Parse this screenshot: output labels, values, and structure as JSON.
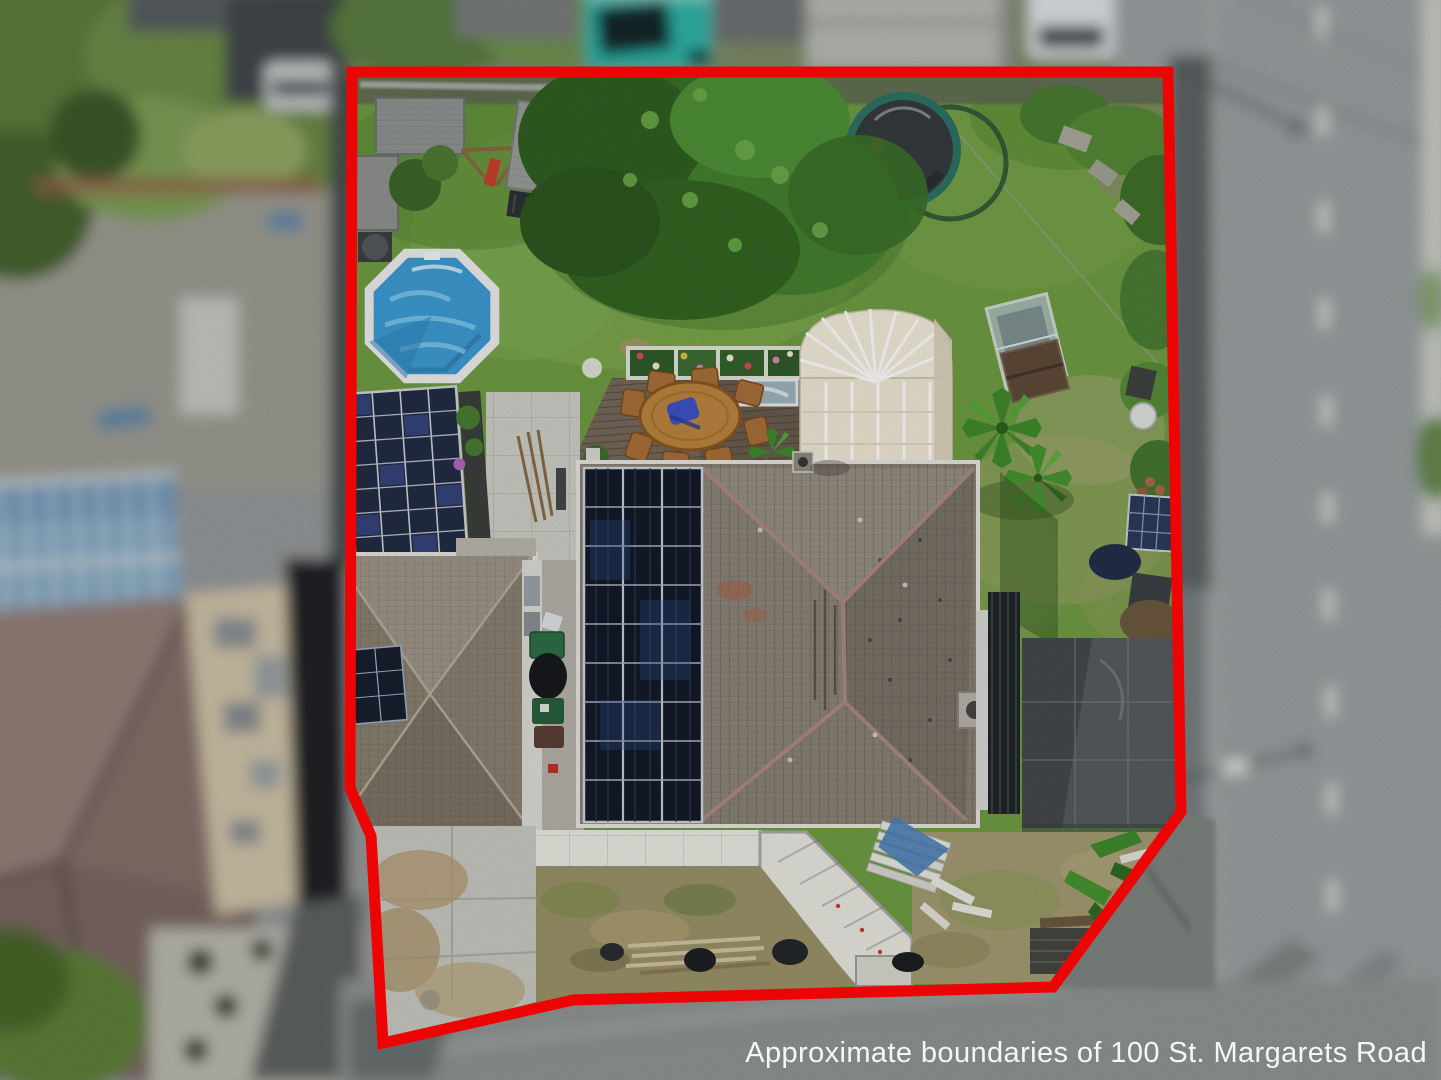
{
  "caption": {
    "text": "Approximate boundaries of 100 St. Margarets Road",
    "color": "#ffffff"
  },
  "boundary": {
    "color": "#ed0505",
    "stroke_width": 11,
    "points": [
      [
        352,
        72
      ],
      [
        1168,
        72
      ],
      [
        1181,
        812
      ],
      [
        1053,
        987
      ],
      [
        573,
        1000
      ],
      [
        383,
        1043
      ],
      [
        371,
        836
      ],
      [
        350,
        788
      ]
    ]
  },
  "scene_colors": {
    "lawn_green": "#6f9c43",
    "road_gray": "#9aa0a1",
    "pool_blue": "#3d9bd3",
    "solar_panel_dark": "#131a28",
    "roof_gray_brown": "#8b8175",
    "conservatory_cream": "#efe7d4",
    "deck_wood": "#75685a"
  }
}
